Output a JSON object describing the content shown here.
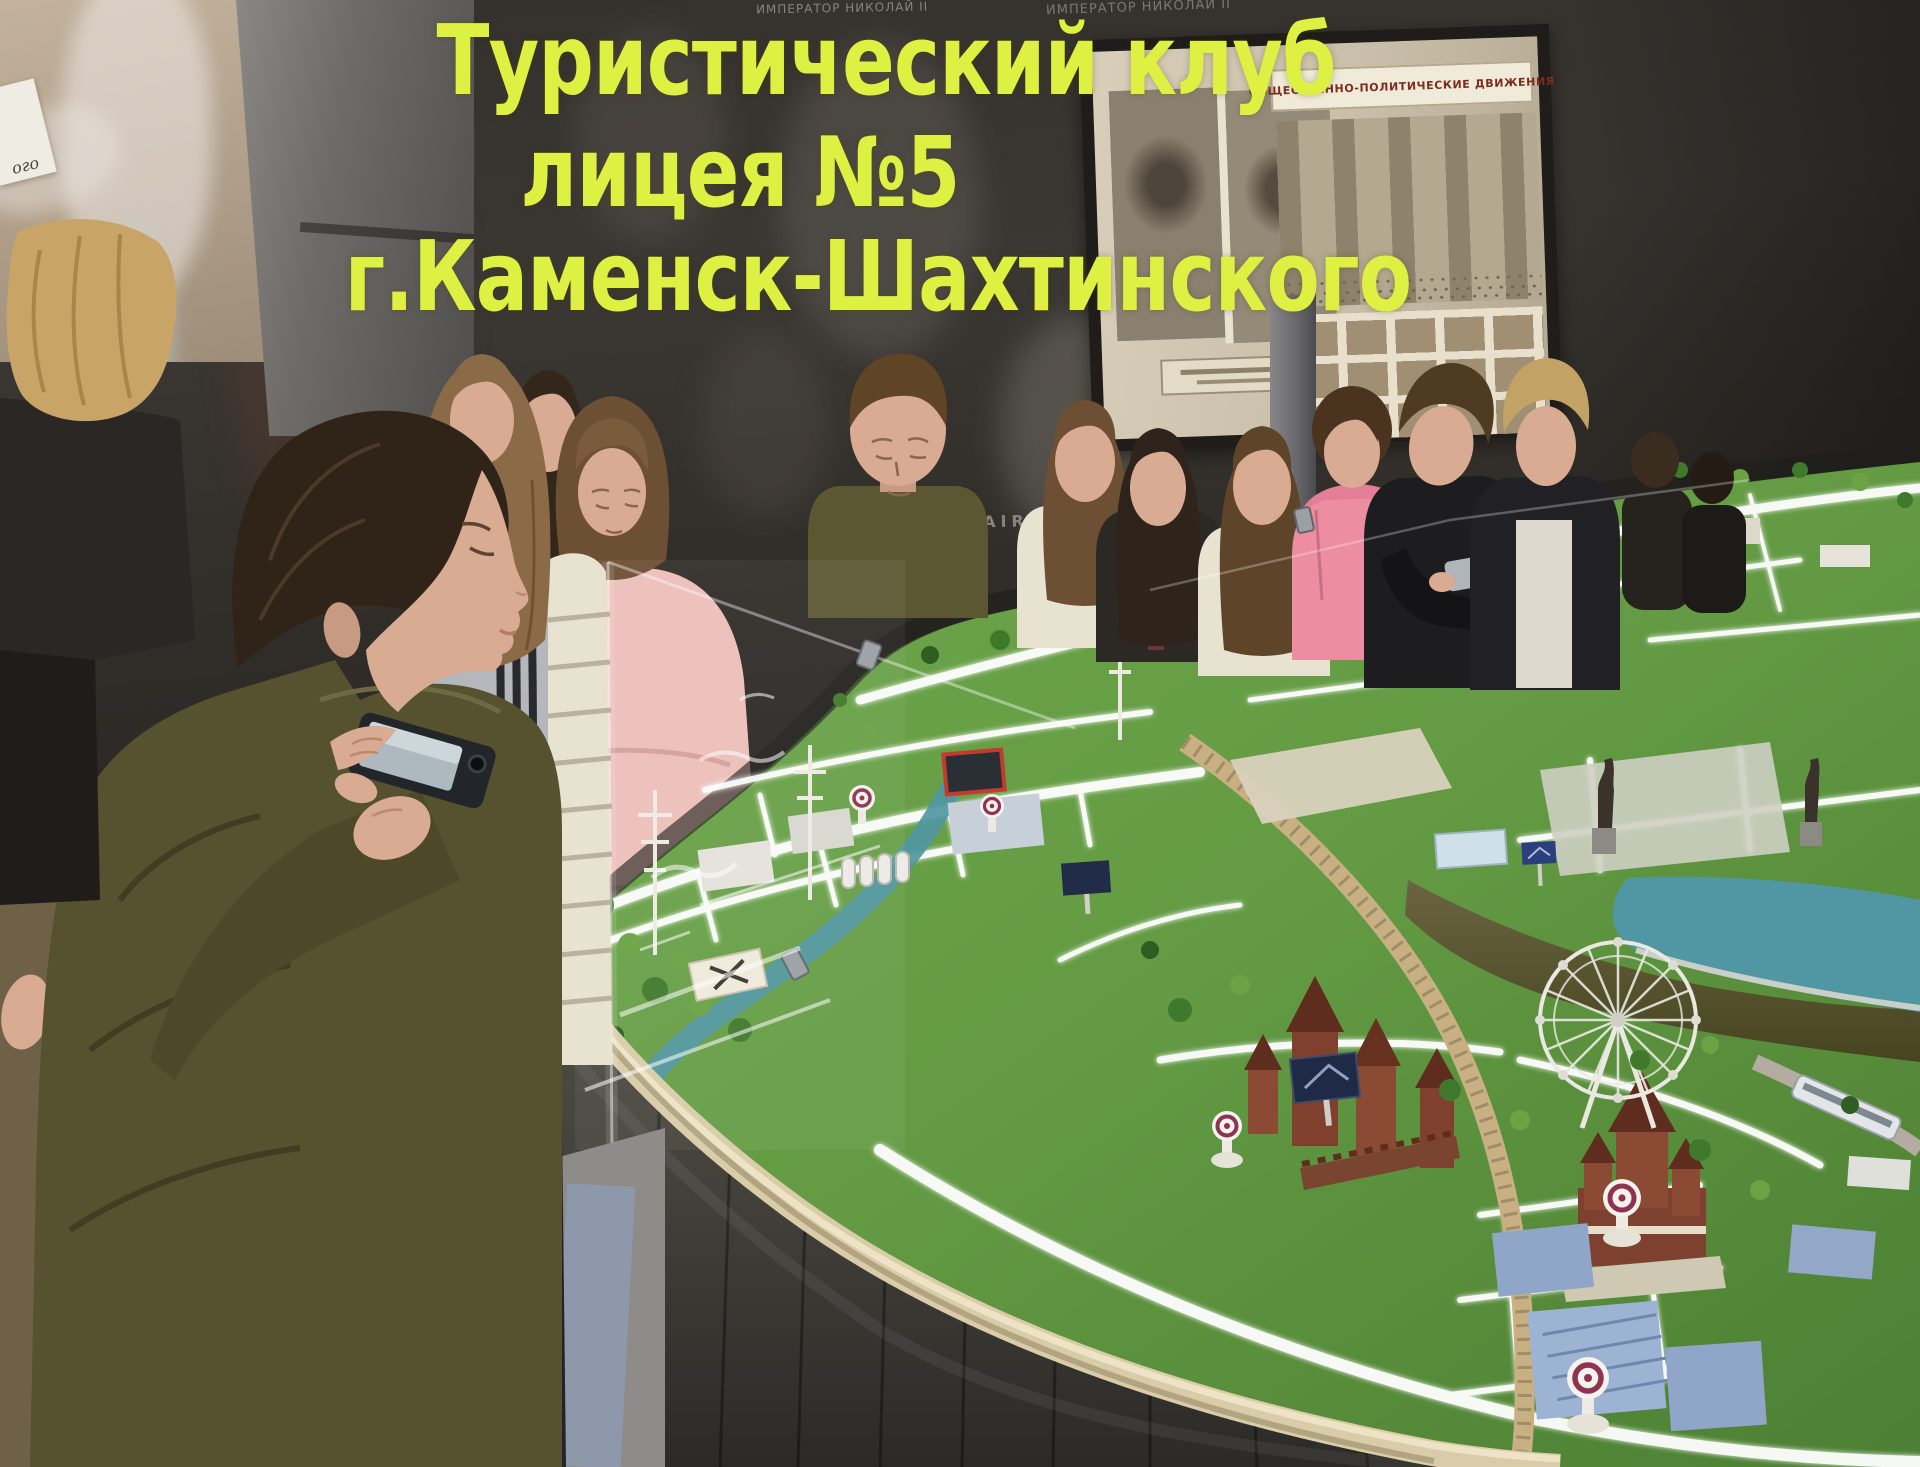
{
  "overlay": {
    "line1": "Туристический клуб",
    "line2": "лицея №5",
    "line3": "г.Каменск-Шахтинского"
  },
  "wall": {
    "poster_label": "ИМПЕРАТОР НИКОЛАЙ II",
    "mural_caption": "CHAIRS",
    "panel_heading": "ОБЩЕСТВЕННО-ПОЛИТИЧЕСКИЕ ДВИЖЕНИЯ",
    "screen_card_fragment": "ого"
  },
  "colors": {
    "title_yellow": "#def042",
    "wall_dark": "#37332e",
    "screen_beige": "#b3a18c",
    "panel_sepia": "#cfc5b2",
    "terrain_green": "#639a43",
    "terrain_green_dark": "#47772e",
    "road_white": "#ffffff",
    "water_teal": "#5097a3",
    "rim_beige": "#d9cda9",
    "base_gray": "#45423c",
    "railway_tan": "#c8b083",
    "castle_brown": "#80402e",
    "marker_maroon": "#8e3352",
    "skin_tone": "#d8ab92",
    "pink_sweater": "#edbfb9",
    "pink_hoodie": "#ec8da1",
    "olive_sweater": "#56512f",
    "cream_sweater": "#e8e2d0"
  }
}
